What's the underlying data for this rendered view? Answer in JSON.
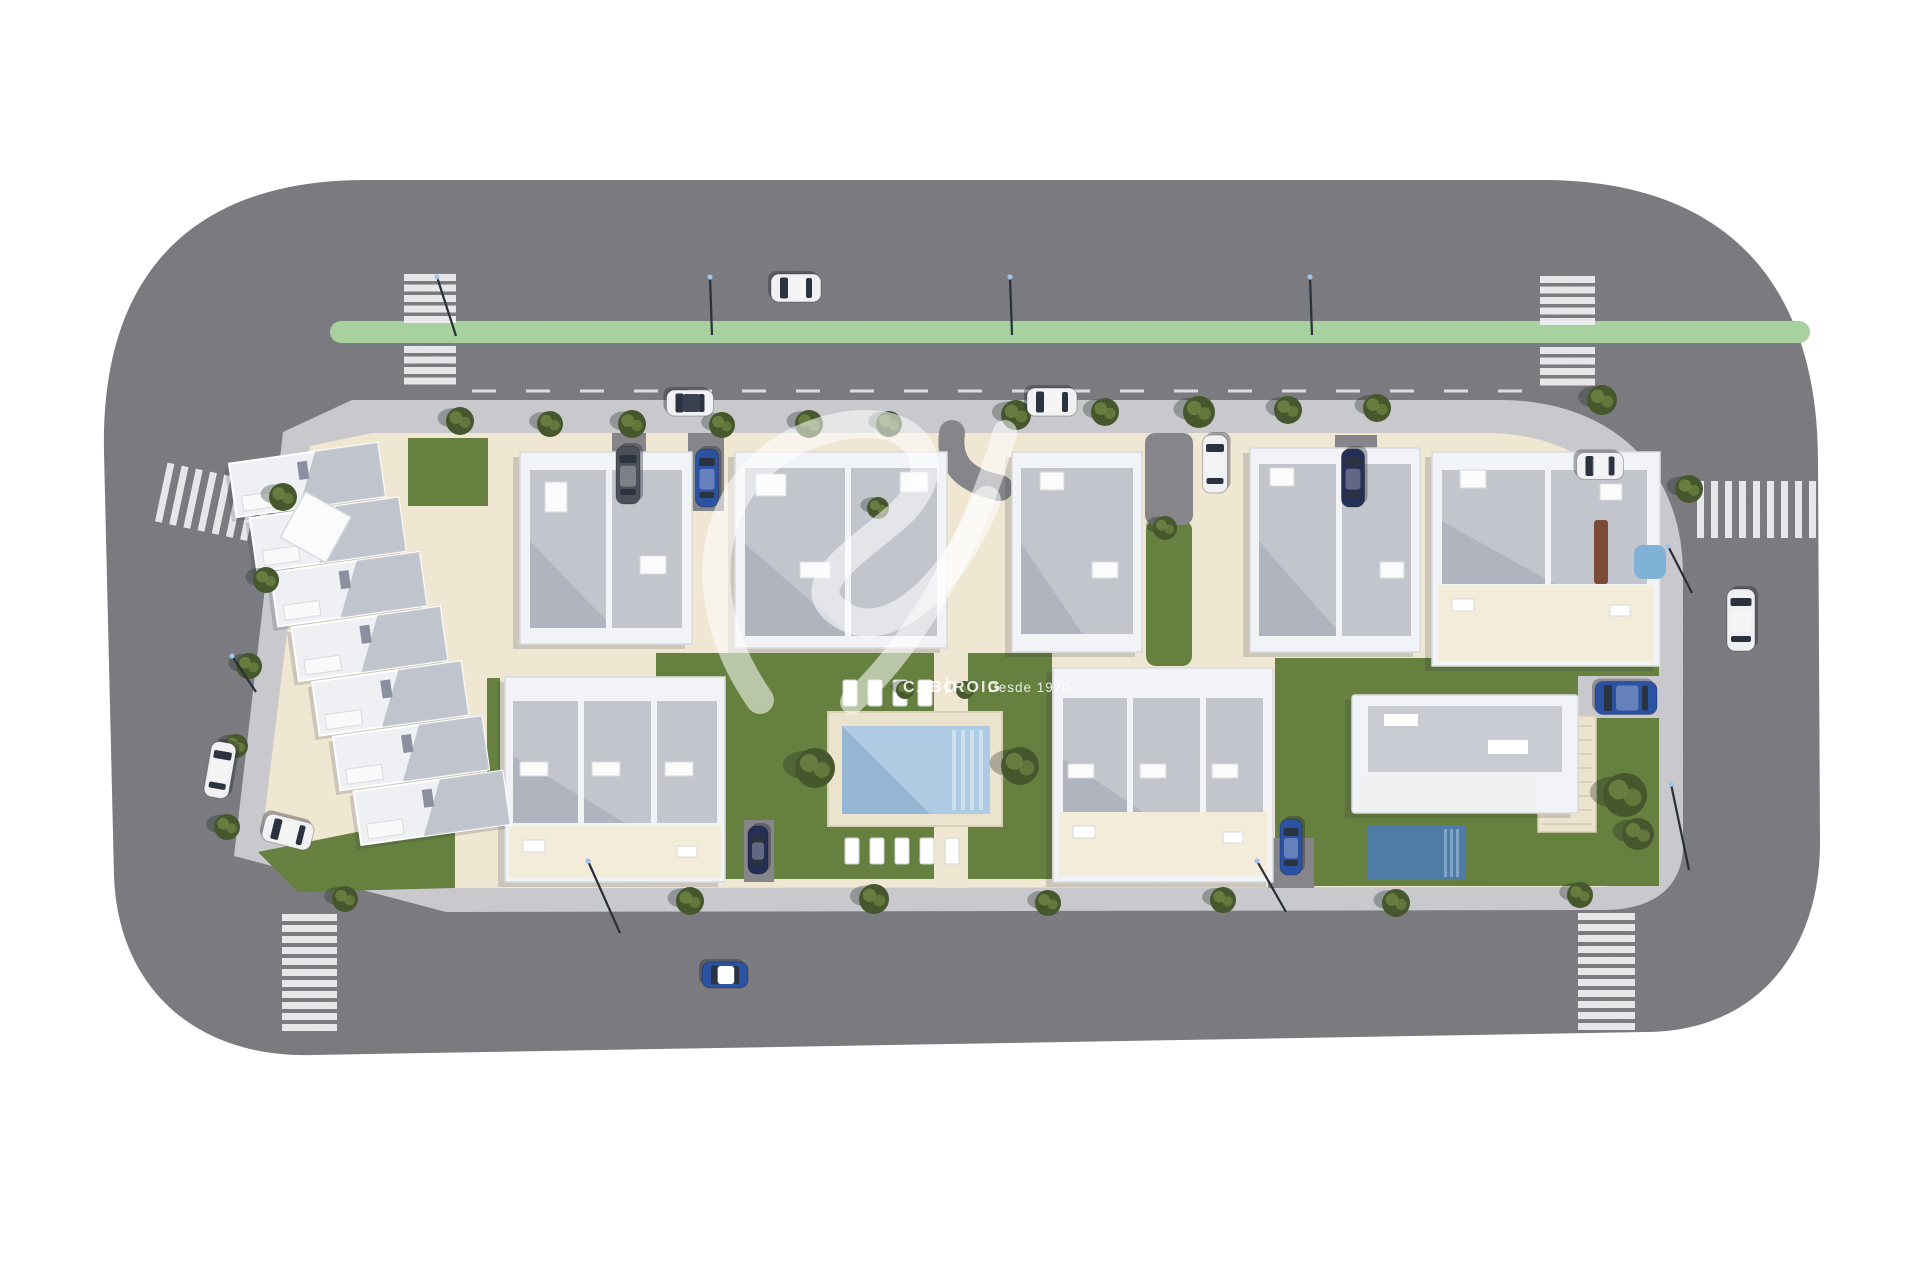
{
  "image_type": "aerial-3d-site-plan-render",
  "watermark": {
    "brand_left": "CABO",
    "brand_right": "ROIG",
    "tagline": "Desde 1970"
  },
  "colors": {
    "background": "#ffffff",
    "road": "#77777c",
    "road_line": "#ededf0",
    "bike_lane": "#a7d2a0",
    "crosswalk": "#f0f0f2",
    "sidewalk": "#c8c8cd",
    "base": "#f0e7d2",
    "terrace": "#f3ecd9",
    "lawn": "#66813f",
    "lawn_dark": "#50682f",
    "tree": "#46572e",
    "tree_light": "#6d8442",
    "building_white": "#f2f3f6",
    "building_edge": "#d8dade",
    "roof_gray": "#c2c5cc",
    "roof_dark": "#9aa0ad",
    "deck": "#ece3cf",
    "deck_edge": "#d9d0b8",
    "pool_light": "#aecbe3",
    "pool_step": "#cfe2f0",
    "pool_dark": "#4f7ca6",
    "driveway": "#85858a",
    "car_white": "#f1f1f3",
    "car_blue": "#2b52a3",
    "car_navy": "#252e55",
    "car_gray": "#4b5059",
    "glass": "#2c3340",
    "shadow": "rgba(45,50,65,0.18)",
    "watermark": "rgba(255,255,255,0.55)",
    "watermark_text": "rgba(255,255,255,0.85)",
    "pergola_brown": "#7c4b36",
    "spa_blue": "#7fb2d6",
    "lamp": "#2a2f3a",
    "lamp_tip": "#9fc4e8"
  },
  "scene": {
    "green_lane": {
      "x": 330,
      "y": 321,
      "w": 1480,
      "h": 22,
      "rx": 11
    },
    "center_dashes": {
      "x1": 472,
      "y": 391,
      "x2": 1532,
      "dash": "24 30",
      "width": 3
    },
    "crosswalks": [
      {
        "x": 404,
        "y": 274,
        "sw": 52,
        "sh": 7,
        "count": 5,
        "pitch": 10.5,
        "axis": "y"
      },
      {
        "x": 404,
        "y": 346,
        "sw": 52,
        "sh": 7,
        "count": 4,
        "pitch": 10.5,
        "axis": "y"
      },
      {
        "x": 1540,
        "y": 276,
        "sw": 55,
        "sh": 7,
        "count": 5,
        "pitch": 10.5,
        "axis": "y"
      },
      {
        "x": 1540,
        "y": 347,
        "sw": 55,
        "sh": 7,
        "count": 4,
        "pitch": 10.5,
        "axis": "y"
      },
      {
        "x": 282,
        "y": 914,
        "sw": 55,
        "sh": 7,
        "count": 11,
        "pitch": 11,
        "axis": "y"
      },
      {
        "x": 1578,
        "y": 913,
        "sw": 57,
        "sh": 7,
        "count": 11,
        "pitch": 11,
        "axis": "y"
      },
      {
        "x": 160,
        "y": 474,
        "sw": 7,
        "sh": 60,
        "count": 8,
        "pitch": 14.5,
        "axis": "x",
        "rot": 12
      },
      {
        "x": 1697,
        "y": 481,
        "sw": 7,
        "sh": 57,
        "count": 9,
        "pitch": 14,
        "axis": "x"
      }
    ],
    "lamps": [
      [
        710,
        277,
        712,
        335
      ],
      [
        1010,
        277,
        1012,
        335
      ],
      [
        1310,
        277,
        1312,
        335
      ],
      [
        437,
        277,
        456,
        336
      ],
      [
        588,
        861,
        620,
        933
      ],
      [
        1257,
        861,
        1286,
        912
      ],
      [
        1668,
        546,
        1692,
        593
      ],
      [
        1671,
        784,
        1689,
        870
      ],
      [
        232,
        656,
        256,
        692
      ]
    ],
    "lawns": [
      {
        "type": "rect",
        "x": 408,
        "y": 438,
        "w": 80,
        "h": 68
      },
      {
        "type": "poly",
        "points": "258,852 455,812 455,888 298,892"
      },
      {
        "type": "rect",
        "x": 487,
        "y": 678,
        "w": 13,
        "h": 140
      },
      {
        "type": "rect",
        "x": 656,
        "y": 653,
        "w": 396,
        "h": 226
      },
      {
        "type": "rect",
        "x": 1275,
        "y": 658,
        "w": 384,
        "h": 228
      },
      {
        "type": "rect",
        "x": 1146,
        "y": 520,
        "w": 46,
        "h": 146,
        "rx": 10
      },
      {
        "type": "rect",
        "x": 850,
        "y": 488,
        "w": 26,
        "h": 44
      }
    ],
    "driveways": [
      {
        "x": 612,
        "y": 433,
        "w": 34,
        "h": 78
      },
      {
        "x": 688,
        "y": 433,
        "w": 36,
        "h": 78
      },
      {
        "x": 1145,
        "y": 433,
        "w": 48,
        "h": 92,
        "rx": 10
      },
      {
        "x": 1335,
        "y": 435,
        "w": 42,
        "h": 80
      },
      {
        "x": 744,
        "y": 820,
        "w": 30,
        "h": 62
      },
      {
        "x": 1268,
        "y": 838,
        "w": 46,
        "h": 50
      }
    ],
    "ramp_path": "M 952,433 C 948,462 962,480 1000,488",
    "townhouse_row": {
      "x": 256,
      "y": 450,
      "n": 7,
      "uw": 150,
      "uh": 54,
      "sx": 13,
      "sy": 57,
      "rot": -8,
      "cx": 340,
      "cy": 650,
      "pergola": [
        333,
        525,
        52
      ]
    },
    "buildings": [
      {
        "id": "apartment-b1",
        "x": 520,
        "y": 452,
        "w": 172,
        "h": 192,
        "roof": [
          10,
          18,
          152,
          158
        ],
        "div": [
          606
        ],
        "boxes": [
          [
            545,
            482,
            22,
            30
          ],
          [
            640,
            556,
            26,
            18
          ]
        ]
      },
      {
        "id": "apartment-b2",
        "x": 735,
        "y": 452,
        "w": 212,
        "h": 196,
        "roof": [
          10,
          16,
          192,
          168
        ],
        "div": [
          845
        ],
        "boxes": [
          [
            756,
            474,
            30,
            22
          ],
          [
            900,
            472,
            28,
            20
          ],
          [
            800,
            562,
            30,
            16
          ]
        ]
      },
      {
        "id": "apartment-b3",
        "x": 1012,
        "y": 452,
        "w": 130,
        "h": 200,
        "roof": [
          9,
          16,
          112,
          166
        ],
        "div": [],
        "boxes": [
          [
            1040,
            472,
            24,
            18
          ],
          [
            1092,
            562,
            26,
            16
          ]
        ]
      },
      {
        "id": "apartment-b4",
        "x": 1250,
        "y": 448,
        "w": 170,
        "h": 204,
        "roof": [
          9,
          16,
          152,
          172
        ],
        "div": [
          1336
        ],
        "boxes": [
          [
            1270,
            468,
            24,
            18
          ],
          [
            1380,
            562,
            24,
            16
          ]
        ]
      },
      {
        "id": "apartment-b5",
        "x": 1432,
        "y": 452,
        "w": 228,
        "h": 214,
        "roof": [
          10,
          18,
          205,
          114
        ],
        "div": [
          1545
        ],
        "boxes": [
          [
            1460,
            470,
            26,
            18
          ],
          [
            1600,
            484,
            22,
            16
          ]
        ],
        "terrace": [
          1438,
          585,
          216,
          76
        ]
      },
      {
        "id": "rowhouse-f",
        "x": 505,
        "y": 677,
        "w": 220,
        "h": 205,
        "roof": [
          8,
          24,
          204,
          122
        ],
        "div": [
          578,
          651
        ],
        "boxes": [
          [
            520,
            762,
            28,
            14
          ],
          [
            592,
            762,
            28,
            14
          ],
          [
            665,
            762,
            28,
            14
          ]
        ],
        "terrace": [
          509,
          826,
          212,
          52
        ]
      },
      {
        "id": "rowhouse-h",
        "x": 1053,
        "y": 668,
        "w": 220,
        "h": 214,
        "roof": [
          10,
          30,
          200,
          134
        ],
        "div": [
          1127,
          1200
        ],
        "boxes": [
          [
            1068,
            764,
            26,
            14
          ],
          [
            1140,
            764,
            26,
            14
          ],
          [
            1212,
            764,
            26,
            14
          ]
        ],
        "terrace": [
          1059,
          812,
          208,
          64
        ]
      }
    ],
    "extras": [
      {
        "x": 1594,
        "y": 520,
        "w": 14,
        "h": 64,
        "rx": 3,
        "color": "pergola_brown",
        "name": "wooden-pergola"
      },
      {
        "x": 1634,
        "y": 545,
        "w": 32,
        "h": 34,
        "rx": 9,
        "color": "spa_blue",
        "name": "rooftop-spa"
      }
    ],
    "community_pool": {
      "deck": [
        828,
        712,
        174,
        114
      ],
      "water": [
        842,
        726,
        148,
        88
      ],
      "steps_x": 952,
      "path": [
        934,
        653,
        34,
        235
      ],
      "lounger_size": [
        14,
        26
      ],
      "loungers_top": {
        "y": 680,
        "xs": [
          843,
          868,
          893,
          918
        ]
      },
      "loungers_bottom": {
        "y": 838,
        "xs": [
          845,
          870,
          895,
          920,
          945
        ]
      }
    },
    "villa": {
      "body": [
        1352,
        695,
        226,
        118
      ],
      "roof_panel": [
        1368,
        706,
        194,
        66
      ],
      "terrace": [
        1358,
        776,
        178,
        36
      ],
      "pool": [
        1368,
        826,
        98,
        54
      ],
      "path": [
        1538,
        716,
        58,
        116
      ],
      "car_pad": [
        1578,
        676,
        84,
        42
      ]
    },
    "cars": [
      {
        "x": 796,
        "y": 288,
        "len": 50,
        "wid": 28,
        "a": 0,
        "c": "white"
      },
      {
        "x": 628,
        "y": 475,
        "len": 58,
        "wid": 24,
        "a": 90,
        "c": "gray"
      },
      {
        "x": 707,
        "y": 478,
        "len": 58,
        "wid": 23,
        "a": 90,
        "c": "blue"
      },
      {
        "x": 690,
        "y": 403,
        "len": 47,
        "wid": 26,
        "a": 0,
        "c": "white",
        "open": true
      },
      {
        "x": 1052,
        "y": 402,
        "len": 50,
        "wid": 28,
        "a": 0,
        "c": "white"
      },
      {
        "x": 1215,
        "y": 464,
        "len": 58,
        "wid": 25,
        "a": 90,
        "c": "white"
      },
      {
        "x": 1353,
        "y": 478,
        "len": 58,
        "wid": 23,
        "a": 90,
        "c": "navy"
      },
      {
        "x": 1600,
        "y": 466,
        "len": 47,
        "wid": 27,
        "a": 0,
        "c": "white"
      },
      {
        "x": 1741,
        "y": 620,
        "len": 62,
        "wid": 28,
        "a": 90,
        "c": "white"
      },
      {
        "x": 1626,
        "y": 698,
        "len": 62,
        "wid": 33,
        "a": 0,
        "c": "blue"
      },
      {
        "x": 220,
        "y": 770,
        "len": 56,
        "wid": 25,
        "a": 100,
        "c": "white"
      },
      {
        "x": 288,
        "y": 832,
        "len": 50,
        "wid": 28,
        "a": 14,
        "c": "white"
      },
      {
        "x": 725,
        "y": 975,
        "len": 46,
        "wid": 26,
        "a": 0,
        "c": "blue",
        "roof": "white"
      },
      {
        "x": 758,
        "y": 850,
        "len": 48,
        "wid": 20,
        "a": 90,
        "c": "navy"
      },
      {
        "x": 1291,
        "y": 847,
        "len": 56,
        "wid": 22,
        "a": 90,
        "c": "blue"
      }
    ],
    "trees": [
      [
        460,
        421,
        14
      ],
      [
        550,
        424,
        13
      ],
      [
        632,
        424,
        14
      ],
      [
        722,
        425,
        13
      ],
      [
        809,
        424,
        14
      ],
      [
        889,
        424,
        13
      ],
      [
        1016,
        415,
        15
      ],
      [
        1105,
        412,
        14
      ],
      [
        1199,
        412,
        16
      ],
      [
        1288,
        410,
        14
      ],
      [
        1377,
        408,
        14
      ],
      [
        1602,
        400,
        15
      ],
      [
        1689,
        489,
        14
      ],
      [
        283,
        497,
        14
      ],
      [
        266,
        580,
        13
      ],
      [
        249,
        666,
        13
      ],
      [
        236,
        746,
        12
      ],
      [
        227,
        827,
        13
      ],
      [
        345,
        899,
        13
      ],
      [
        690,
        901,
        14
      ],
      [
        874,
        899,
        15
      ],
      [
        1048,
        903,
        13
      ],
      [
        1223,
        900,
        13
      ],
      [
        1396,
        903,
        14
      ],
      [
        1580,
        895,
        13
      ],
      [
        815,
        768,
        20
      ],
      [
        1020,
        766,
        19
      ],
      [
        1625,
        795,
        22
      ],
      [
        1638,
        834,
        16
      ],
      [
        1165,
        528,
        12
      ],
      [
        878,
        508,
        11
      ],
      [
        905,
        690,
        9
      ],
      [
        965,
        690,
        9
      ]
    ],
    "watermark_swoosh": [
      {
        "d": "M 760,700 C 680,585 715,462 825,430 C 916,404 958,466 893,520 C 845,560 800,588 842,615 C 888,644 952,586 987,500",
        "w": 28
      },
      {
        "d": "M 1005,432 C 972,548 912,648 852,702",
        "w": 24
      }
    ],
    "watermark_layout": {
      "brand_x": 903,
      "brand_y": 692,
      "divider_x": 947,
      "right_x": 953,
      "tagline_x": 988,
      "tagline_y": 692
    }
  }
}
